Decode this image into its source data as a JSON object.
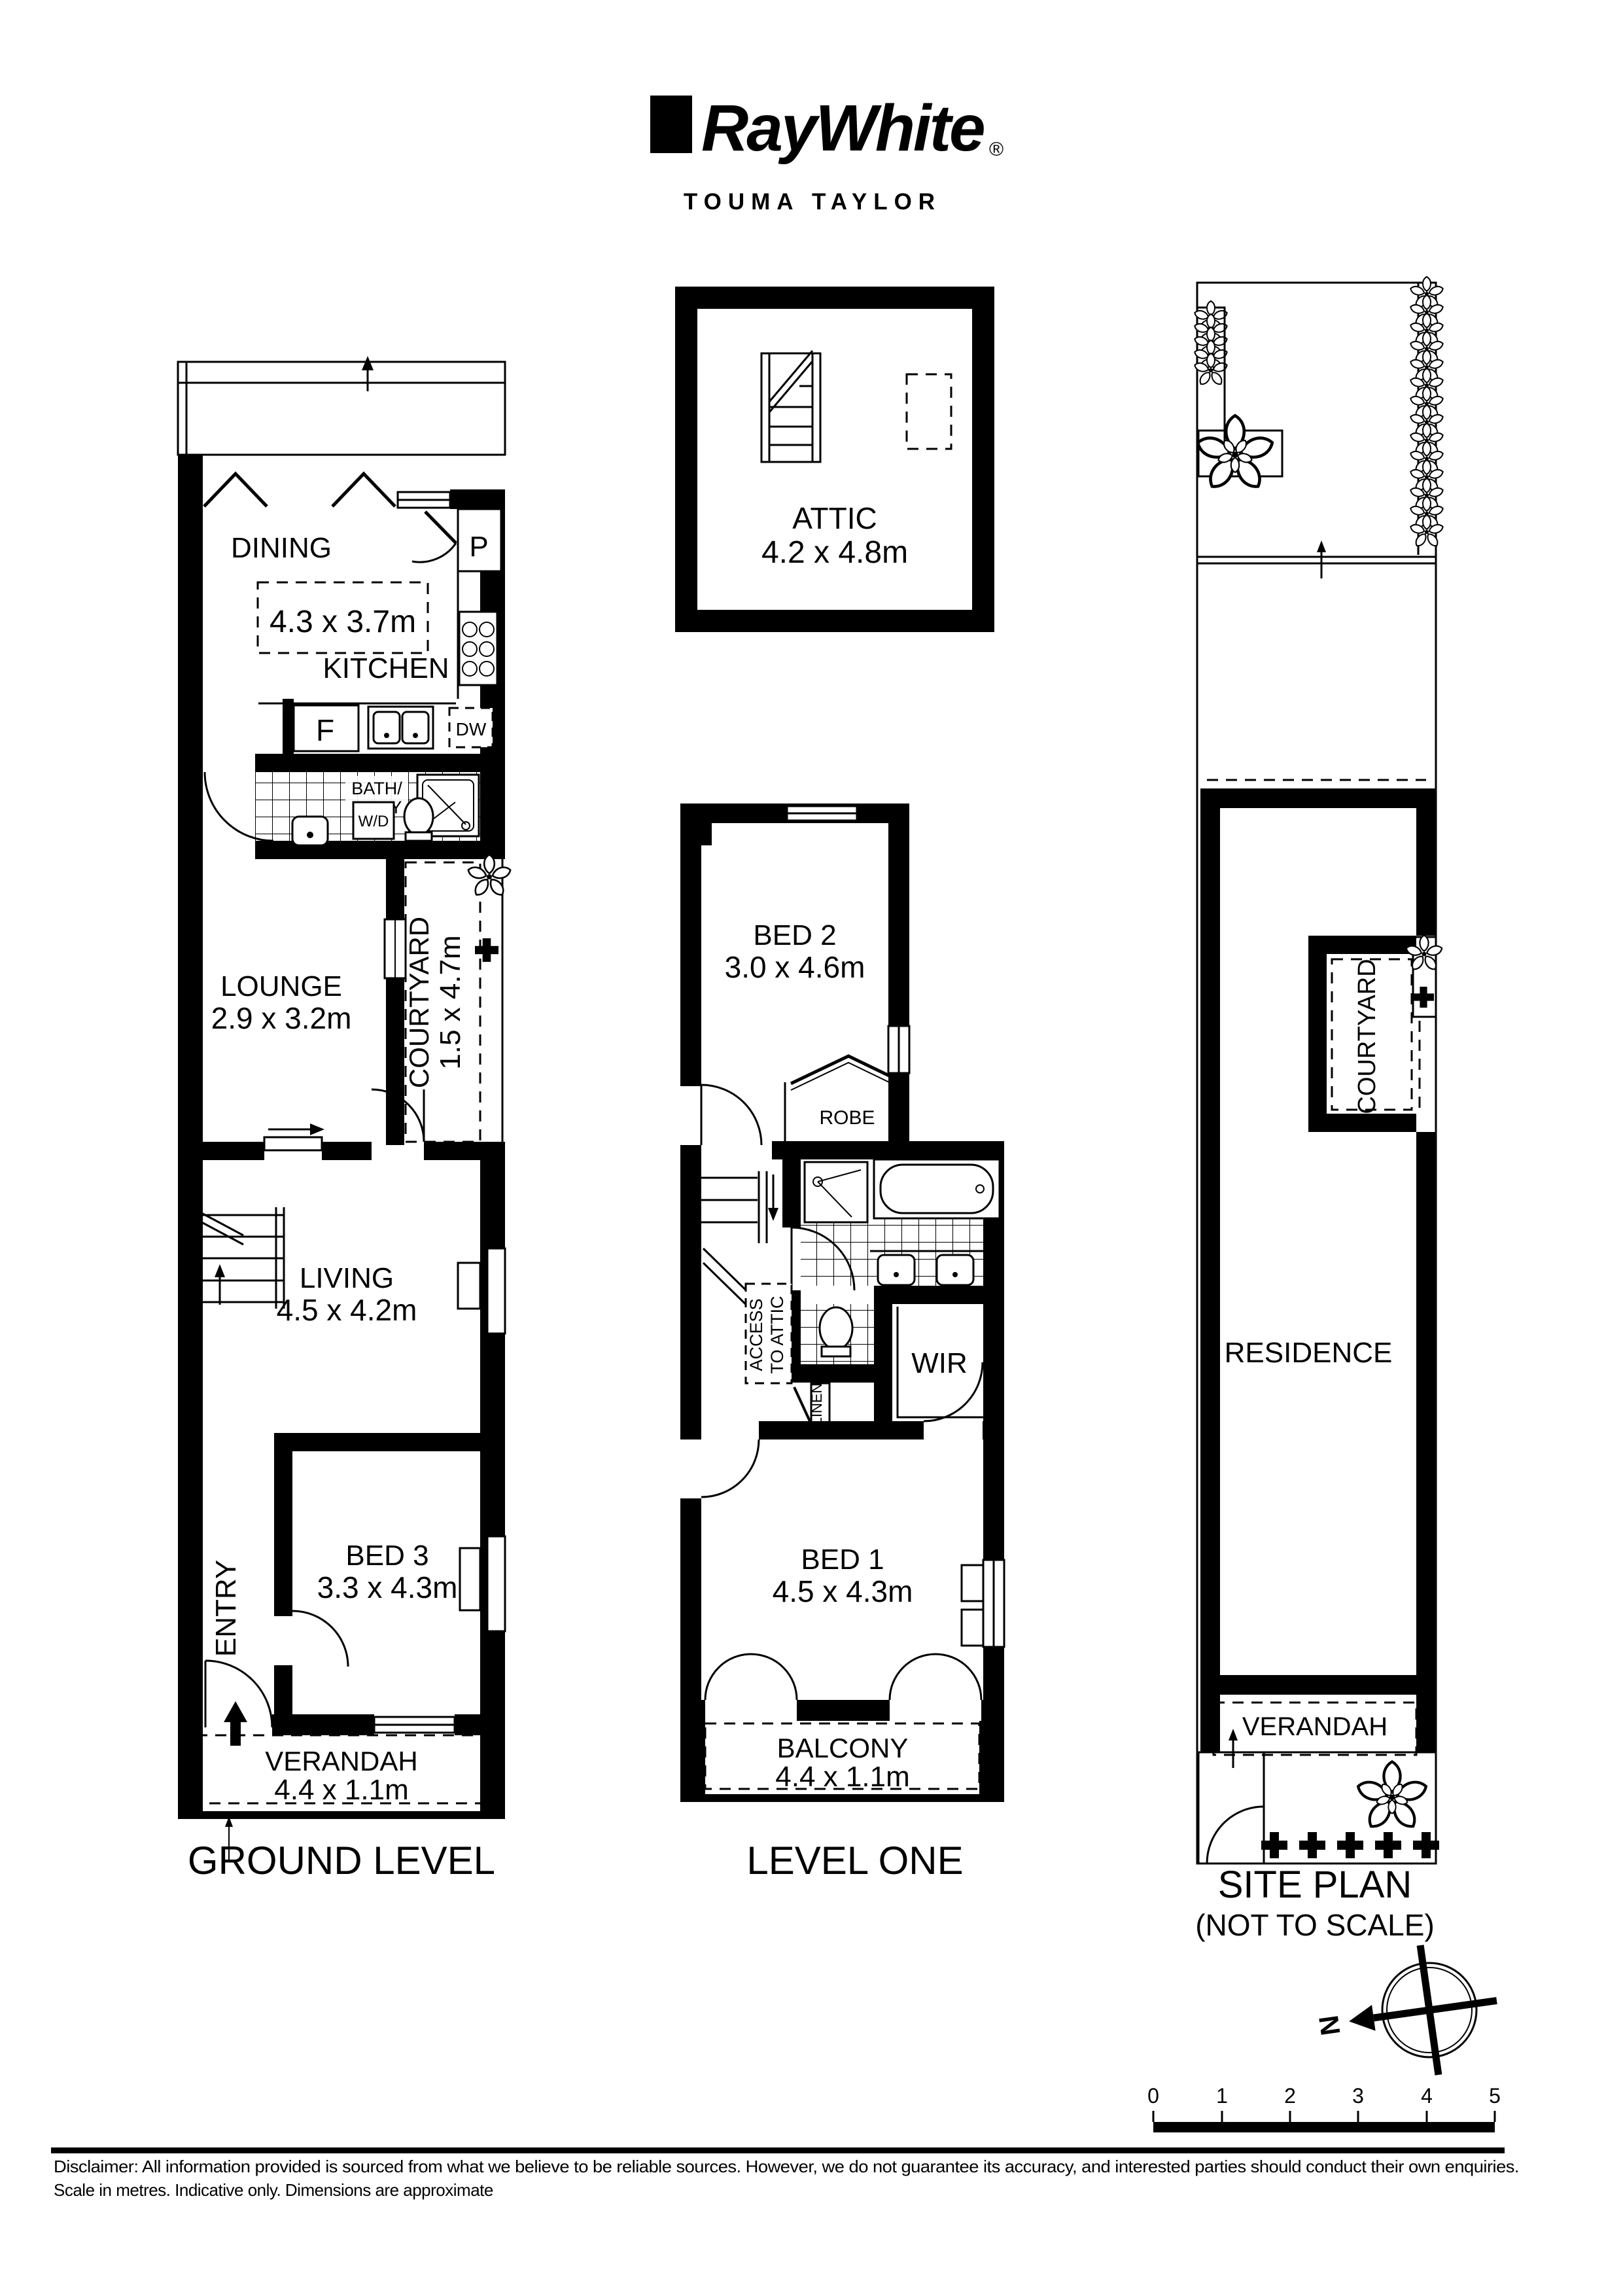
{
  "header": {
    "brand": "RayWhite",
    "registered": "®",
    "agency": "TOUMA TAYLOR"
  },
  "ground": {
    "title": "GROUND LEVEL",
    "dining": {
      "name": "DINING",
      "dims": "4.3 x 3.7m"
    },
    "kitchen": {
      "name": "KITCHEN"
    },
    "pantry": "P",
    "fridge": "F",
    "dishwasher": "DW",
    "washer": "W/D",
    "bath": {
      "line1": "BATH/",
      "line2": "L'DRY"
    },
    "lounge": {
      "name": "LOUNGE",
      "dims": "2.9 x 3.2m"
    },
    "courtyard": {
      "name": "COURTYARD",
      "dims": "1.5 x 4.7m"
    },
    "living": {
      "name": "LIVING",
      "dims": "4.5 x 4.2m"
    },
    "bed3": {
      "name": "BED 3",
      "dims": "3.3 x 4.3m"
    },
    "entry": "ENTRY",
    "verandah": {
      "name": "VERANDAH",
      "dims": "4.4 x 1.1m"
    }
  },
  "attic": {
    "name": "ATTIC",
    "dims": "4.2 x 4.8m"
  },
  "level_one": {
    "title": "LEVEL ONE",
    "bed2": {
      "name": "BED 2",
      "dims": "3.0 x 4.6m"
    },
    "robe": "ROBE",
    "access": {
      "line1": "ACCESS",
      "line2": "TO ATTIC"
    },
    "linen": "LINEN",
    "wir": "WIR",
    "bed1": {
      "name": "BED 1",
      "dims": "4.5 x 4.3m"
    },
    "balcony": {
      "name": "BALCONY",
      "dims": "4.4 x 1.1m"
    }
  },
  "site": {
    "title": "SITE PLAN",
    "subtitle": "(NOT TO SCALE)",
    "courtyard": "COURTYARD",
    "residence": "RESIDENCE",
    "verandah": "VERANDAH",
    "north": "N",
    "scale_ticks": [
      "0",
      "1",
      "2",
      "3",
      "4",
      "5"
    ]
  },
  "footer": {
    "disclaimer_line1": "Disclaimer: All information provided is sourced from what we believe to be reliable sources. However, we do not guarantee  its  accuracy, and interested parties should conduct their own enquiries.",
    "disclaimer_line2": "Scale in metres. Indicative only. Dimensions are approximate"
  }
}
